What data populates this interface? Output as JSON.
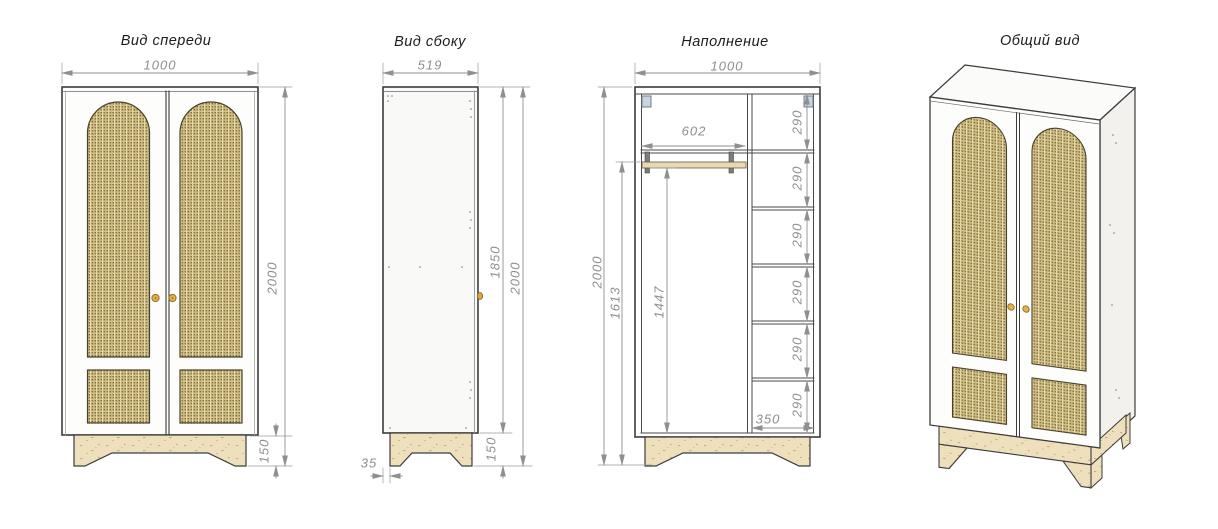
{
  "titles": {
    "front": "Вид спереди",
    "side": "Вид сбоку",
    "interior": "Наполнение",
    "overall": "Общий вид"
  },
  "dimensions": {
    "front": {
      "width": "1000",
      "total_height": "2000",
      "leg_height": "150"
    },
    "side": {
      "depth": "519",
      "body_height": "1850",
      "total_height": "2000",
      "leg_height": "150",
      "leg_inset": "35"
    },
    "interior": {
      "width": "1000",
      "rod_section_width": "602",
      "shelf_pitch": "290",
      "shelf_section_width": "350",
      "total_height": "2000",
      "rod_height": "1613",
      "rod_clear_height": "1447"
    }
  },
  "colors": {
    "outline": "#3c3c3c",
    "dimension": "#8f8f8f",
    "rattan": "#d9c78c",
    "rattan_dot": "#7d6d42",
    "wood": "#eee0bd",
    "bracket": "#c9d6e2",
    "knob": "#e0b14f"
  }
}
